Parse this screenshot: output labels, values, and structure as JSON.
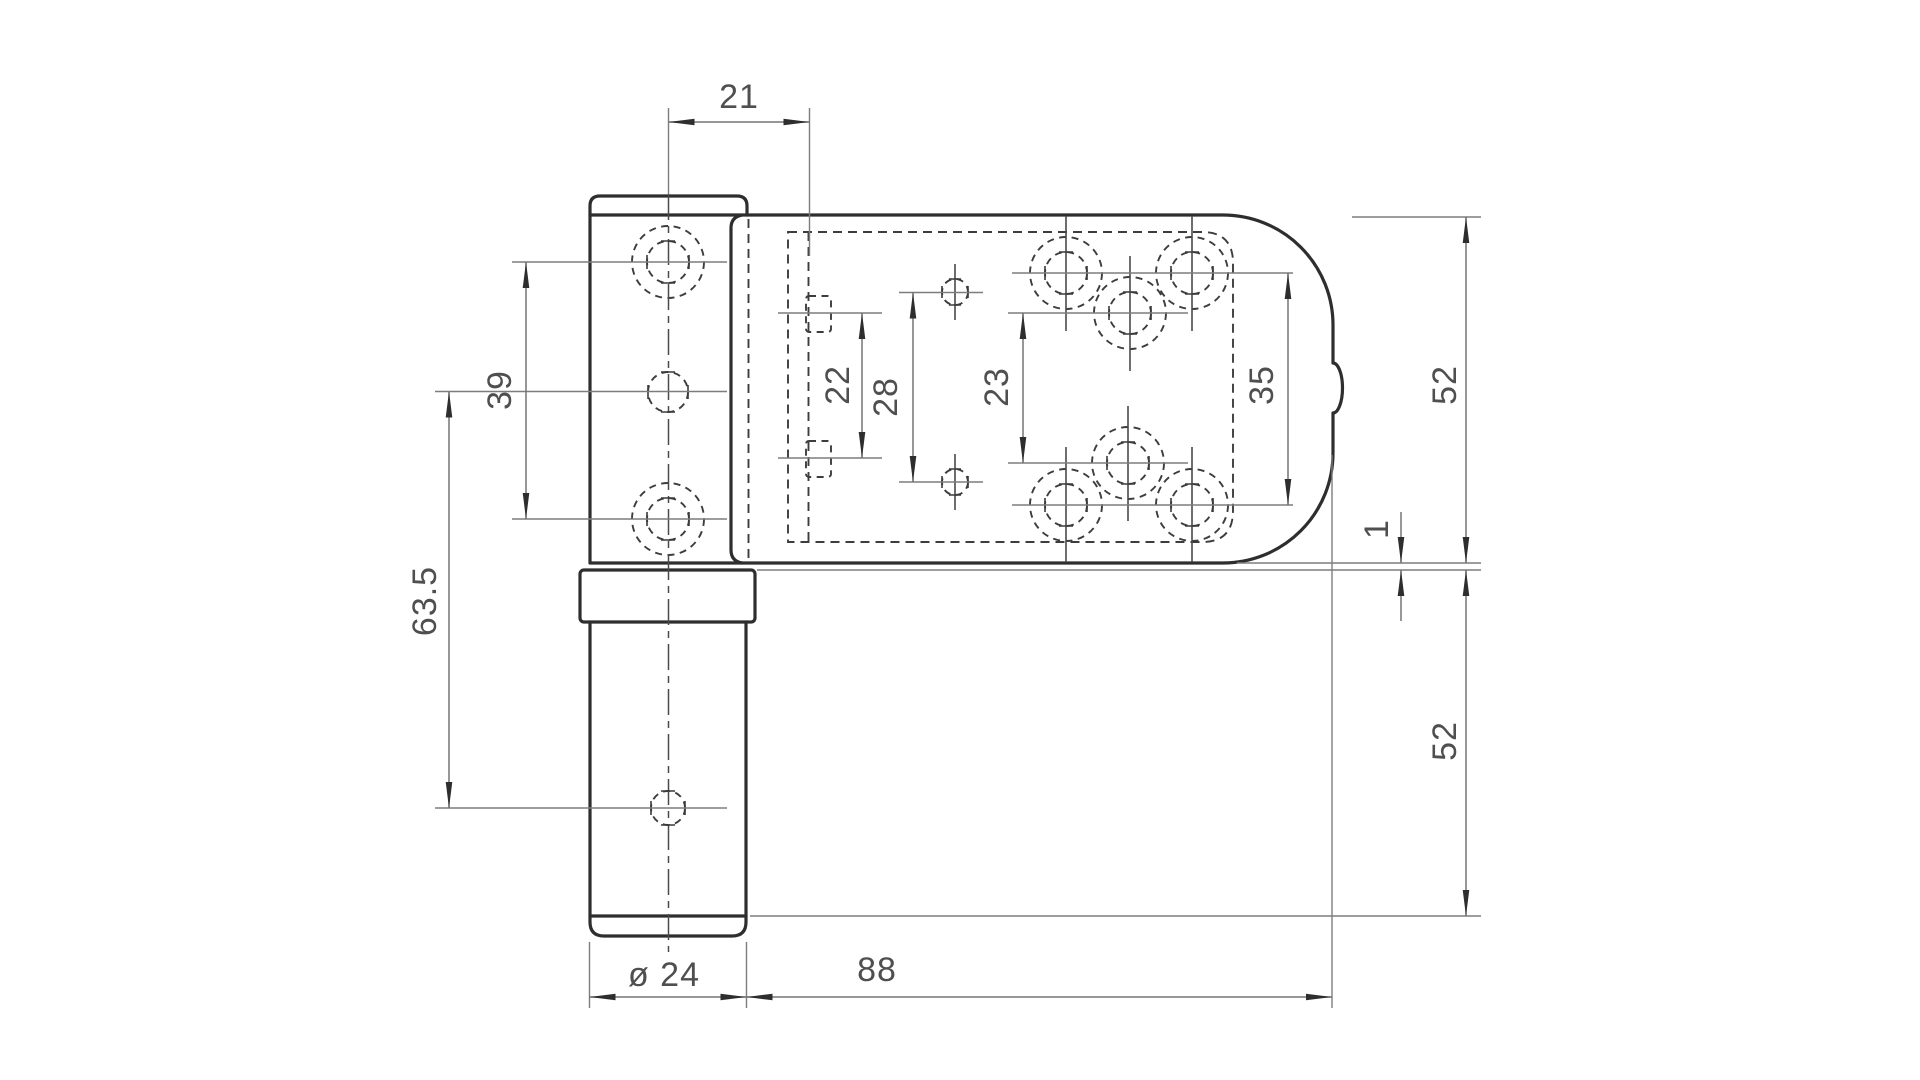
{
  "drawing": {
    "kind": "technical-dimension-drawing",
    "subject": "door hinge side elevation",
    "colors": {
      "background": "#ffffff",
      "outline": "#2e2e2e",
      "hidden_lines": "#3d3d3d",
      "dimension_lines": "#757575",
      "dimension_text": "#4f4f4f"
    },
    "labels": {
      "dim_21": "21",
      "dim_39": "39",
      "dim_63_5": "63.5",
      "dim_22": "22",
      "dim_28": "28",
      "dim_23": "23",
      "dim_35": "35",
      "dim_52_top": "52",
      "dim_1": "1",
      "dim_52_bottom": "52",
      "dim_dia_24": "ø 24",
      "dim_88": "88"
    }
  }
}
